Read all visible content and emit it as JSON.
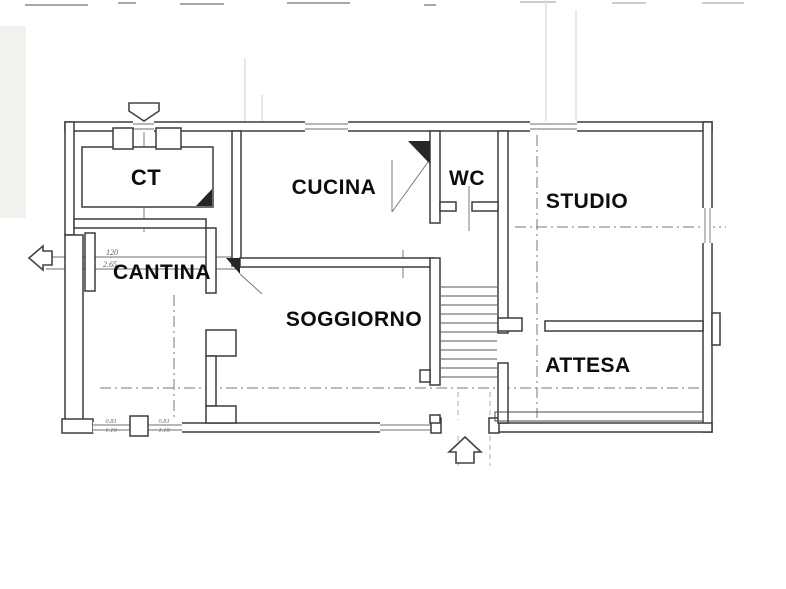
{
  "plan": {
    "rooms": [
      {
        "id": "ct",
        "label": "CT"
      },
      {
        "id": "cucina",
        "label": "CUCINA"
      },
      {
        "id": "wc",
        "label": "WC"
      },
      {
        "id": "studio",
        "label": "STUDIO"
      },
      {
        "id": "cantina",
        "label": "CANTINA"
      },
      {
        "id": "soggiorno",
        "label": "SOGGIORNO"
      },
      {
        "id": "attesa",
        "label": "ATTESA"
      }
    ],
    "dimensions": {
      "side_door_width": "120",
      "side_door_height": "2.65",
      "window_left_width": "0.81",
      "window_left_height": "1.10",
      "window_right_width": "0.81",
      "window_right_height": "1.10"
    },
    "colors": {
      "wall": "#3c3c3c",
      "label": "#0d0d0d",
      "paper": "#ffffff",
      "dash": "#7a7a7a"
    }
  }
}
